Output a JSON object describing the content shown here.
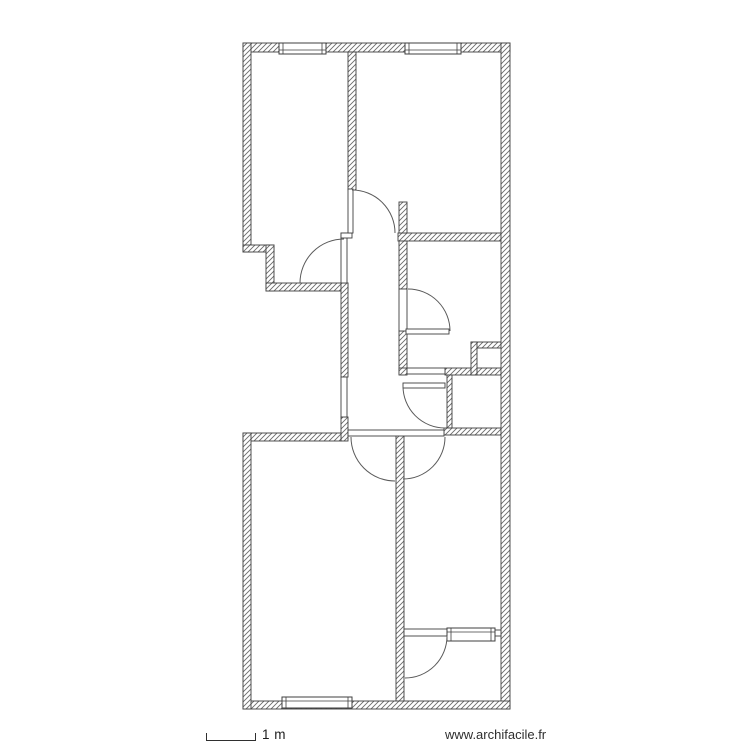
{
  "footer": {
    "scale_label": "1 m",
    "website": "www.archifacile.fr"
  },
  "plan": {
    "colors": {
      "line": "#3f3f3f",
      "hatch": "#6b6b6b",
      "arc": "#5a5a5a",
      "background": "#ffffff"
    },
    "walls": [
      {
        "name": "wall-top-exterior",
        "x": 243,
        "y": 43,
        "w": 267,
        "h": 9,
        "hatched": true
      },
      {
        "name": "wall-left-upper-exterior",
        "x": 243,
        "y": 43,
        "w": 8,
        "h": 209,
        "hatched": true
      },
      {
        "name": "wall-step-horizontal",
        "x": 243,
        "y": 245,
        "w": 31,
        "h": 7,
        "hatched": true
      },
      {
        "name": "wall-step-vertical",
        "x": 266,
        "y": 245,
        "w": 8,
        "h": 46,
        "hatched": true
      },
      {
        "name": "wall-topleft-room-bottom",
        "x": 266,
        "y": 283,
        "w": 82,
        "h": 8,
        "hatched": true
      },
      {
        "name": "wall-top-rooms-divider",
        "x": 348,
        "y": 52,
        "w": 8,
        "h": 138,
        "hatched": true
      },
      {
        "name": "wall-corridor-left-upper",
        "x": 341,
        "y": 283,
        "w": 7,
        "h": 94,
        "hatched": true
      },
      {
        "name": "wall-corridor-left-lower",
        "x": 341,
        "y": 417,
        "w": 7,
        "h": 24,
        "hatched": true
      },
      {
        "name": "wall-mid-horizontal-upper",
        "x": 398,
        "y": 233,
        "w": 103,
        "h": 8,
        "hatched": true
      },
      {
        "name": "wall-corridor-right-stub",
        "x": 399,
        "y": 202,
        "w": 8,
        "h": 31,
        "hatched": true
      },
      {
        "name": "wall-corridor-right-upper",
        "x": 399,
        "y": 241,
        "w": 8,
        "h": 48,
        "hatched": true
      },
      {
        "name": "wall-corridor-right-lower",
        "x": 399,
        "y": 331,
        "w": 8,
        "h": 43,
        "hatched": true
      },
      {
        "name": "wall-mid-horizontal2-left",
        "x": 399,
        "y": 368,
        "w": 8,
        "h": 7,
        "hatched": true
      },
      {
        "name": "wall-mid-horizontal2-right",
        "x": 445,
        "y": 368,
        "w": 56,
        "h": 7,
        "hatched": true
      },
      {
        "name": "wall-closet-left",
        "x": 447,
        "y": 375,
        "w": 5,
        "h": 53,
        "hatched": true
      },
      {
        "name": "wall-closet-bottom",
        "x": 444,
        "y": 428,
        "w": 57,
        "h": 7,
        "hatched": true
      },
      {
        "name": "wall-shaft-top",
        "x": 471,
        "y": 342,
        "w": 30,
        "h": 6,
        "hatched": true
      },
      {
        "name": "wall-shaft-left",
        "x": 471,
        "y": 342,
        "w": 6,
        "h": 33,
        "hatched": true
      },
      {
        "name": "wall-bottomleft-room-top",
        "x": 243,
        "y": 433,
        "w": 98,
        "h": 8,
        "hatched": true
      },
      {
        "name": "wall-bottom-rooms-divider",
        "x": 396,
        "y": 435,
        "w": 8,
        "h": 274,
        "hatched": true
      },
      {
        "name": "wall-right-exterior",
        "x": 501,
        "y": 43,
        "w": 9,
        "h": 666,
        "hatched": true
      },
      {
        "name": "wall-bottom-exterior",
        "x": 243,
        "y": 701,
        "w": 267,
        "h": 8,
        "hatched": true
      },
      {
        "name": "wall-left-lower-exterior",
        "x": 243,
        "y": 433,
        "w": 8,
        "h": 276,
        "hatched": true
      },
      {
        "name": "door1-leaf",
        "x": 341,
        "y": 233,
        "w": 6,
        "h": 50,
        "hatched": false
      },
      {
        "name": "corridor-top-connector",
        "x": 341,
        "y": 233,
        "w": 11,
        "h": 5,
        "hatched": false
      },
      {
        "name": "wall-corridor-left-thin",
        "x": 341,
        "y": 377,
        "w": 6,
        "h": 40,
        "hatched": false
      },
      {
        "name": "hall-door-wall-line",
        "x": 348,
        "y": 430,
        "w": 96,
        "h": 6,
        "hatched": false
      },
      {
        "name": "door4-opening-line",
        "x": 407,
        "y": 368,
        "w": 38,
        "h": 6,
        "hatched": false
      },
      {
        "name": "door3-opening-line",
        "x": 399,
        "y": 289,
        "w": 8,
        "h": 42,
        "hatched": false
      },
      {
        "name": "door2-leaf",
        "x": 348,
        "y": 189,
        "w": 5,
        "h": 44,
        "hatched": false
      },
      {
        "name": "door3-leaf",
        "x": 406,
        "y": 329,
        "w": 43,
        "h": 5,
        "hatched": false
      },
      {
        "name": "door4-leaf",
        "x": 403,
        "y": 383,
        "w": 42,
        "h": 5,
        "hatched": false
      },
      {
        "name": "wall-bottomright-divider-thin",
        "x": 404,
        "y": 629,
        "w": 43,
        "h": 7,
        "hatched": false
      },
      {
        "name": "wall-bottomright-divider-bit",
        "x": 495,
        "y": 630,
        "w": 6,
        "h": 6,
        "hatched": false
      }
    ],
    "doors": [
      {
        "name": "door-arc-topleft-room",
        "arc": "M 300,283 A 44 44 0 0 1 344,239"
      },
      {
        "name": "door-arc-corridor-top",
        "arc": "M 352,190 A 43 43 0 0 1 395,233"
      },
      {
        "name": "door-arc-midright-room",
        "arc": "M 408,289 A 42 42 0 0 1 450,331"
      },
      {
        "name": "door-arc-midbottom-area",
        "arc": "M 403,386 A 42 42 0 0 0 445,428"
      },
      {
        "name": "door-arc-bottomleft-room",
        "arc": "M 351,437 A 44 44 0 0 0 395,481"
      },
      {
        "name": "door-arc-bottomright-room",
        "arc": "M 445,437 A 42 42 0 0 1 403,479"
      },
      {
        "name": "door-arc-bottomfarright-room",
        "arc": "M 447,636 A 42 42 0 0 1 405,678"
      }
    ],
    "windows": [
      {
        "name": "window-top-left",
        "x": 279,
        "y": 43,
        "w": 47,
        "h": 11,
        "line_y": 50
      },
      {
        "name": "window-top-right",
        "x": 405,
        "y": 43,
        "w": 56,
        "h": 11,
        "line_y": 50
      },
      {
        "name": "window-bottom",
        "x": 282,
        "y": 697,
        "w": 70,
        "h": 11,
        "line_y": 701
      },
      {
        "name": "window-interior-bottomright",
        "x": 447,
        "y": 628,
        "w": 48,
        "h": 13,
        "line_y": 632
      }
    ]
  }
}
